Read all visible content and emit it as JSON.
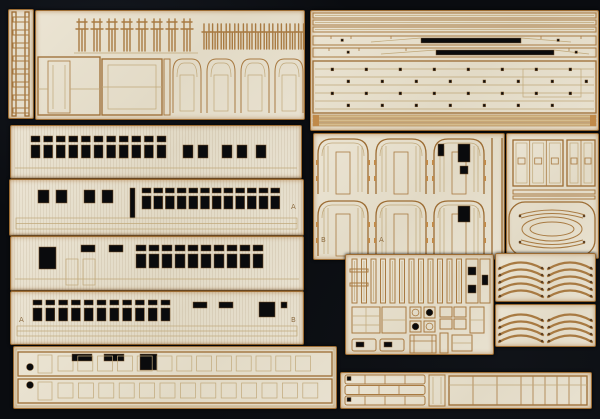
{
  "meta": {
    "subject": "Photograph of laser-cut wooden model kit sheets (railway carriage kit) arranged on a black background"
  },
  "palette": {
    "background": "#0a0c10",
    "sheet_wood": "#e6dfcd",
    "burn_edge": "#a87a42",
    "etch_line": "#c0a87a",
    "cutout_hole": "#0a0b0d",
    "laminate_strip": "#d5bc8e",
    "etched_letter": "#8f6f45"
  },
  "letters": {
    "a2_right": "A",
    "b2_left": "A",
    "b2_right": "B",
    "arch_b": "B",
    "arch_a": "A"
  },
  "parts": [
    "step ladder",
    "seat profile sprues",
    "wall panels with doors and arched partitions",
    "slotted roof battens and long strips",
    "floor plate with mounting holes",
    "laminated step strips",
    "carriage side A upper window row",
    "carriage side A lower window row",
    "carriage side B upper window row",
    "carriage side B lower window row",
    "arched end walls with doors",
    "door leaves",
    "oval roof-end frame",
    "small fittings: ribs, tables, washers, benches",
    "nested roof ribs (two sheets)",
    "glazing frame strips with drilled holes",
    "segmented footboard strips"
  ]
}
